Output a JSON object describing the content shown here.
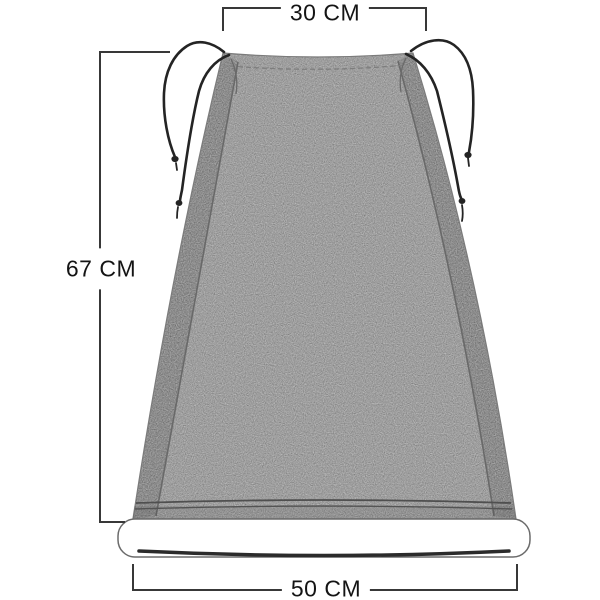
{
  "diagram": {
    "product": "gray drawstring fabric cover with rolled bottom bar",
    "dimensions": {
      "top_width": "30 CM",
      "height": "67 CM",
      "bottom_width": "50 CM"
    },
    "colors": {
      "background": "#ffffff",
      "fabric_main": "#9d9d9d",
      "fabric_side_panel": "#8a8a8a",
      "seam_line": "#696969",
      "drawstring_cord": "#242424",
      "bottom_roll_fill": "#ffffff",
      "bottom_roll_crease": "#2b2b2b",
      "dimension_line": "#383838",
      "dimension_text": "#141414"
    }
  }
}
